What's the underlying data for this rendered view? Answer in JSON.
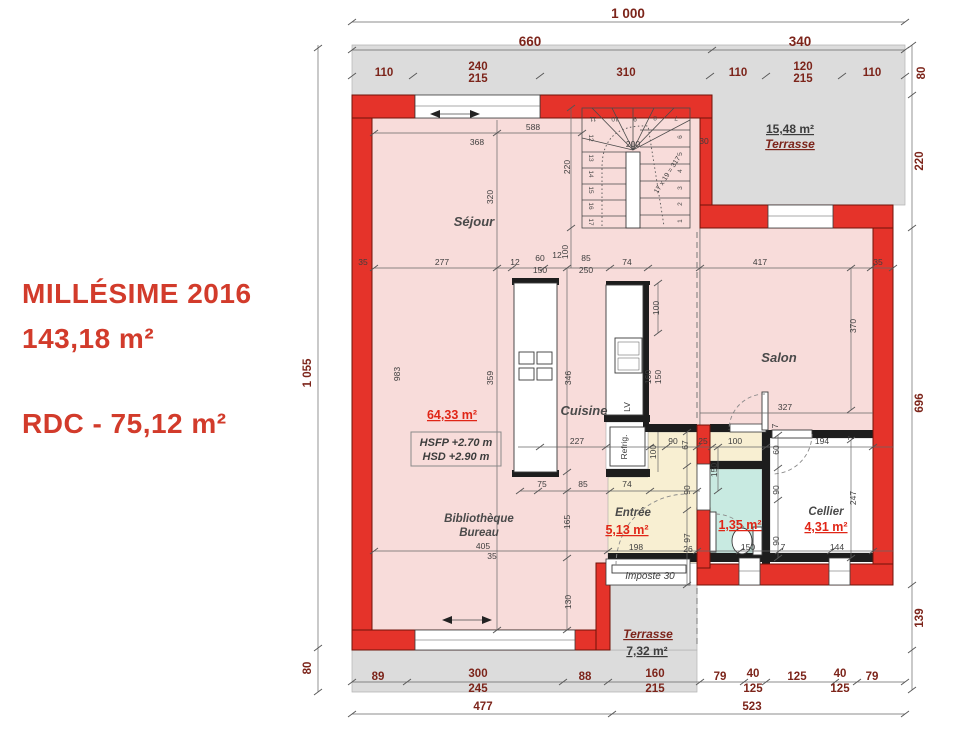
{
  "title": {
    "name": "MILLÉSIME 2016",
    "total_area": "143,18 m²",
    "floor_line": "RDC - 75,12 m²"
  },
  "plan": {
    "rooms": {
      "sejour": {
        "label": "Séjour",
        "area": "64,33 m²"
      },
      "cuisine": {
        "label": "Cuisine"
      },
      "salon": {
        "label": "Salon"
      },
      "entree": {
        "label": "Entrée",
        "area": "5,13 m²"
      },
      "wc": {
        "area": "1,35 m²"
      },
      "cellier": {
        "label": "Cellier",
        "area": "4,31 m²"
      },
      "bibliotheque": {
        "label_line1": "Bibliothèque",
        "label_line2": "Bureau"
      },
      "terrasse_nord": {
        "label": "Terrasse",
        "area": "15,48 m²"
      },
      "terrasse_sud": {
        "label": "Terrasse",
        "area": "7,32 m²"
      }
    },
    "annotations": {
      "ceiling_height_1": "HSFP +2.70 m",
      "ceiling_height_2": "HSD +2.90 m",
      "imposte": "Imposte 30",
      "fridge": "Refrig.",
      "dishwasher": "LV"
    },
    "stairs": {
      "steps": [
        "1",
        "2",
        "3",
        "4",
        "5",
        "6",
        "7",
        "8",
        "9",
        "10",
        "11",
        "12",
        "13",
        "14",
        "15",
        "16",
        "17"
      ],
      "formula": "17 x 19 = 317",
      "width": "200",
      "depth": "220",
      "wall": "30"
    },
    "dims": {
      "top": [
        "1 000",
        "660",
        "340",
        "110",
        "240",
        "215",
        "310",
        "110",
        "120",
        "215",
        "110"
      ],
      "right": [
        "80",
        "220",
        "696",
        "139"
      ],
      "left": [
        "1 055",
        "80"
      ],
      "bottom": [
        "89",
        "300",
        "245",
        "88",
        "160",
        "215",
        "79",
        "40",
        "125",
        "125",
        "40",
        "125",
        "79",
        "477",
        "523"
      ],
      "interior": [
        "588",
        "368",
        "320",
        "277",
        "35",
        "12",
        "60",
        "150",
        "12",
        "100",
        "85",
        "250",
        "74",
        "417",
        "35",
        "100",
        "983",
        "359",
        "346",
        "160",
        "150",
        "370",
        "327",
        "227",
        "90",
        "67",
        "25",
        "100",
        "60",
        "194",
        "7",
        "150",
        "100",
        "90",
        "90",
        "247",
        "75",
        "85",
        "74",
        "165",
        "97",
        "26",
        "150",
        "7",
        "144",
        "198",
        "405",
        "35",
        "130",
        "7",
        "90"
      ]
    },
    "colors": {
      "wall": "#e5332a",
      "interior": "#f8dcda",
      "entree": "#f8efd2",
      "wc": "#c8eae1",
      "exterior": "#dcdcdc",
      "accent_red": "#e02617",
      "dim": "#7c241a"
    }
  }
}
